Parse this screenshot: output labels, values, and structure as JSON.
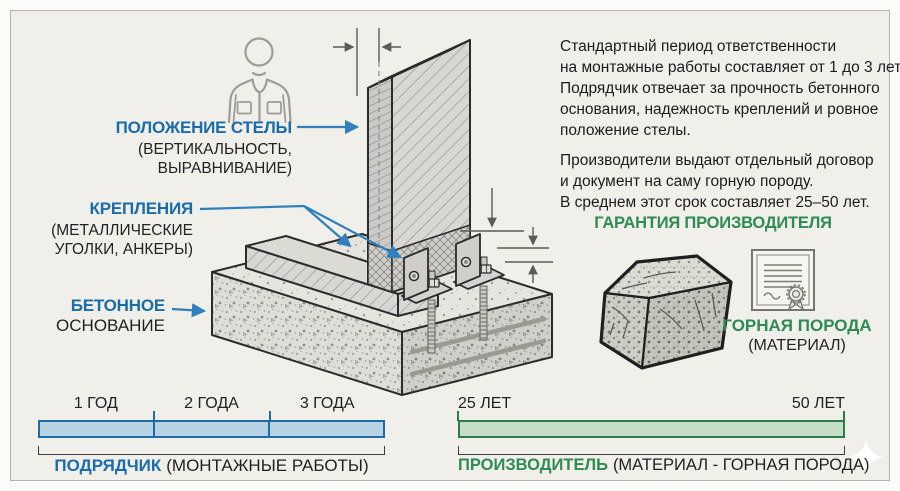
{
  "colors": {
    "background": "#f0efea",
    "frame": "#b5b5ae",
    "text": "#1e1e1e",
    "blue": "#1b6cab",
    "blue_arrow": "#2f80bd",
    "blue_fill": "#b7d2e5",
    "blue_border": "#1f6ba3",
    "green": "#2e8b52",
    "green_fill": "#c6ddc7",
    "green_border": "#2f7b4d",
    "outline": "#2a2a2a"
  },
  "callouts": {
    "stele_position": {
      "title": "ПОЛОЖЕНИЕ СТЕЛЫ",
      "lines": [
        "(ВЕРТИКАЛЬНОСТЬ,",
        "ВЫРАВНИВАНИЕ)"
      ]
    },
    "fasteners": {
      "title": "КРЕПЛЕНИЯ",
      "lines": [
        "(МЕТАЛЛИЧЕСКИЕ",
        "УГОЛКИ, АНКЕРЫ)"
      ]
    },
    "concrete_base": {
      "title": "БЕТОННОЕ",
      "lines": [
        "ОСНОВАНИЕ"
      ]
    }
  },
  "info": {
    "paragraph1_lines": [
      "Стандартный период ответственности",
      "на монтажные работы составляет от 1 до 3 лет.",
      "Подрядчик отвечает за прочность бетонного",
      "основания, надежность креплений и ровное",
      "положение стелы."
    ],
    "paragraph2_lines": [
      "Производители выдают отдельный договор",
      "и документ на саму горную породу.",
      "В среднем этот срок составляет 25–50 лет."
    ]
  },
  "warranty": {
    "heading": "ГАРАНТИЯ ПРОИЗВОДИТЕЛЯ",
    "material_title": "ГОРНАЯ ПОРОДА",
    "material_note": "(МАТЕРИАЛ)"
  },
  "timelines": {
    "contractor": {
      "segments": [
        "1 ГОД",
        "2 ГОДА",
        "3 ГОДА"
      ],
      "years": [
        1,
        2,
        3
      ],
      "label_emph": "ПОДРЯДЧИК",
      "label_note": "(МОНТАЖНЫЕ РАБОТЫ)"
    },
    "manufacturer": {
      "start": "25 ЛЕТ",
      "end": "50 ЛЕТ",
      "years": [
        25,
        50
      ],
      "label_emph": "ПРОИЗВОДИТЕЛЬ",
      "label_note": "(МАТЕРИАЛ - ГОРНАЯ ПОРОДА)"
    }
  },
  "icons": {
    "worker": "worker-outline-icon",
    "rock": "rock-cube-icon",
    "certificate": "certificate-seal-icon",
    "sparkle": "sparkle-watermark"
  }
}
